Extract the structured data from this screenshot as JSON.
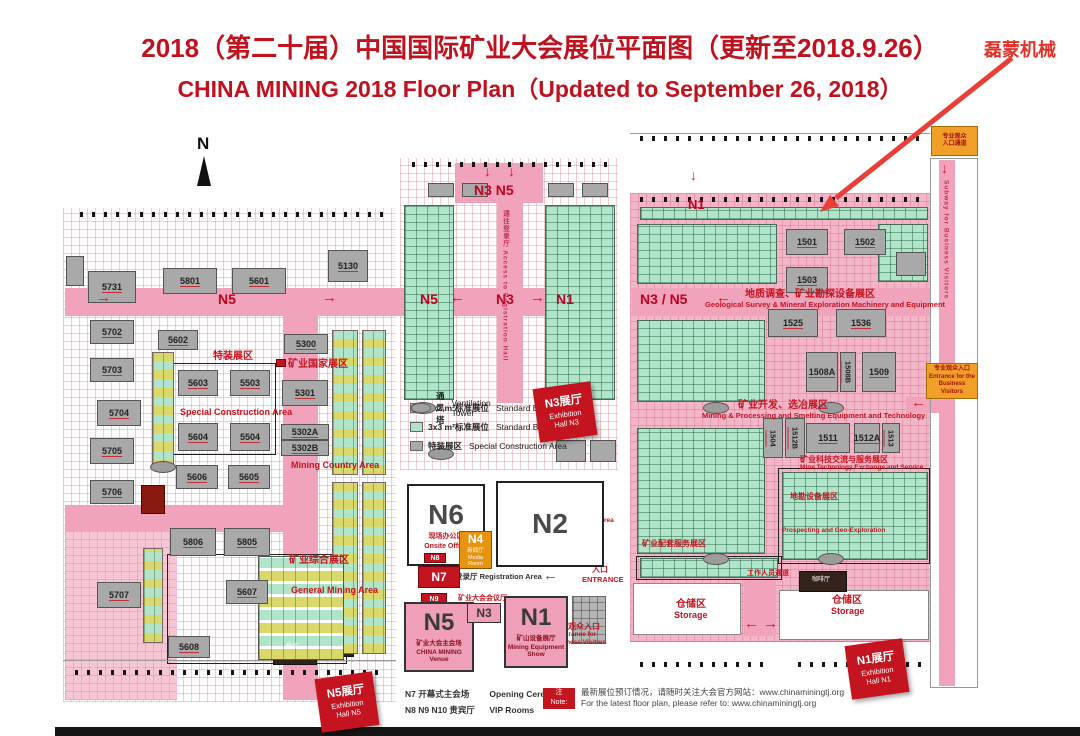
{
  "title": {
    "line1": "2018（第二十届）中国国际矿业大会展位平面图（更新至2018.9.26）",
    "line2": "CHINA MINING 2018 Floor Plan（Updated to September 26, 2018）"
  },
  "annotation": {
    "company": "磊蒙机械"
  },
  "compass": {
    "label": "N"
  },
  "rects": [
    {
      "cls": "hallgrid",
      "x": 63,
      "y": 208,
      "w": 333,
      "h": 494
    },
    {
      "cls": "hallgrid",
      "x": 400,
      "y": 158,
      "w": 218,
      "h": 312
    },
    {
      "cls": "rhall",
      "x": 630,
      "y": 193,
      "w": 301,
      "h": 449
    },
    {
      "cls": "pink",
      "x": 65,
      "y": 288,
      "w": 550,
      "h": 28
    },
    {
      "cls": "pink",
      "x": 632,
      "y": 288,
      "w": 298,
      "h": 28
    },
    {
      "cls": "pink",
      "x": 283,
      "y": 316,
      "w": 35,
      "h": 384
    },
    {
      "cls": "pink",
      "x": 65,
      "y": 505,
      "w": 220,
      "h": 27
    },
    {
      "cls": "pinklight",
      "x": 65,
      "y": 532,
      "w": 112,
      "h": 168
    },
    {
      "cls": "pink",
      "x": 455,
      "y": 163,
      "w": 88,
      "h": 40
    },
    {
      "cls": "pink",
      "x": 497,
      "y": 203,
      "w": 26,
      "h": 200
    },
    {
      "cls": "pink",
      "x": 744,
      "y": 560,
      "w": 32,
      "h": 76
    },
    {
      "cls": "pink",
      "x": 939,
      "y": 160,
      "w": 16,
      "h": 526
    },
    {
      "cls": "pink",
      "x": 906,
      "y": 397,
      "w": 33,
      "h": 16
    },
    {
      "cls": "whitebox",
      "x": 633,
      "y": 583,
      "w": 108,
      "h": 52
    },
    {
      "cls": "whitebox",
      "x": 779,
      "y": 590,
      "w": 150,
      "h": 50
    },
    {
      "cls": "wall",
      "x": 930,
      "y": 158,
      "w": 48,
      "h": 530
    },
    {
      "cls": "wall2",
      "x": 167,
      "y": 554,
      "w": 180,
      "h": 110
    },
    {
      "cls": "wall2",
      "x": 172,
      "y": 363,
      "w": 104,
      "h": 92
    },
    {
      "cls": "wall2",
      "x": 636,
      "y": 556,
      "w": 146,
      "h": 24
    },
    {
      "cls": "wall2",
      "x": 778,
      "y": 468,
      "w": 152,
      "h": 96
    },
    {
      "cls": "tick",
      "x": 80,
      "y": 212,
      "w": 305,
      "h": 5
    },
    {
      "cls": "tick",
      "x": 412,
      "y": 162,
      "w": 195,
      "h": 5
    },
    {
      "cls": "tick",
      "x": 640,
      "y": 197,
      "w": 280,
      "h": 5
    },
    {
      "cls": "tick",
      "x": 640,
      "y": 136,
      "w": 285,
      "h": 5
    },
    {
      "cls": "tick",
      "x": 75,
      "y": 670,
      "w": 310,
      "h": 5
    },
    {
      "cls": "tick",
      "x": 640,
      "y": 662,
      "w": 130,
      "h": 5
    },
    {
      "cls": "tick",
      "x": 798,
      "y": 662,
      "w": 128,
      "h": 5
    },
    {
      "cls": "hline",
      "x": 630,
      "y": 133,
      "w": 300,
      "h": 1
    },
    {
      "cls": "hline",
      "x": 63,
      "y": 660,
      "w": 333,
      "h": 1
    },
    {
      "cls": "hline",
      "x": 630,
      "y": 641,
      "w": 301,
      "h": 1
    },
    {
      "cls": "darkbox",
      "x": 273,
      "y": 632,
      "w": 44,
      "h": 33
    },
    {
      "cls": "darkbox",
      "x": 327,
      "y": 634,
      "w": 27,
      "h": 23
    },
    {
      "cls": "darkbox",
      "x": 799,
      "y": 571,
      "w": 48,
      "h": 21
    },
    {
      "cls": "darkred",
      "x": 141,
      "y": 485,
      "w": 24,
      "h": 29
    },
    {
      "cls": "flag",
      "x": 276,
      "y": 359,
      "w": 10,
      "h": 8
    }
  ],
  "clusters": [
    {
      "cls": "mix-v",
      "x": 152,
      "y": 352,
      "w": 22,
      "h": 118
    },
    {
      "cls": "mix-v",
      "x": 143,
      "y": 548,
      "w": 20,
      "h": 95
    },
    {
      "cls": "mix-v",
      "x": 332,
      "y": 330,
      "w": 26,
      "h": 145
    },
    {
      "cls": "mix-v",
      "x": 332,
      "y": 482,
      "w": 26,
      "h": 172
    },
    {
      "cls": "mix-v",
      "x": 362,
      "y": 330,
      "w": 24,
      "h": 145
    },
    {
      "cls": "mix-v",
      "x": 362,
      "y": 482,
      "w": 24,
      "h": 172
    },
    {
      "cls": "mix-grid",
      "x": 258,
      "y": 556,
      "w": 86,
      "h": 104
    },
    {
      "cls": "green-grid",
      "x": 404,
      "y": 205,
      "w": 50,
      "h": 195
    },
    {
      "cls": "green-grid",
      "x": 545,
      "y": 205,
      "w": 70,
      "h": 195
    },
    {
      "cls": "green-grid",
      "x": 640,
      "y": 207,
      "w": 288,
      "h": 13
    },
    {
      "cls": "green-grid",
      "x": 637,
      "y": 224,
      "w": 140,
      "h": 60
    },
    {
      "cls": "green-grid",
      "x": 878,
      "y": 224,
      "w": 50,
      "h": 58
    },
    {
      "cls": "green-grid",
      "x": 637,
      "y": 320,
      "w": 128,
      "h": 82
    },
    {
      "cls": "green-grid",
      "x": 637,
      "y": 428,
      "w": 128,
      "h": 126
    },
    {
      "cls": "green-grid",
      "x": 640,
      "y": 558,
      "w": 138,
      "h": 20
    },
    {
      "cls": "green-grid",
      "x": 782,
      "y": 472,
      "w": 146,
      "h": 88
    },
    {
      "cls": "gray-grid",
      "x": 546,
      "y": 528,
      "w": 58,
      "h": 36
    },
    {
      "cls": "gray-grid",
      "x": 572,
      "y": 596,
      "w": 34,
      "h": 48
    }
  ],
  "ovals": [
    {
      "x": 150,
      "y": 461
    },
    {
      "x": 428,
      "y": 448
    },
    {
      "x": 703,
      "y": 402
    },
    {
      "x": 818,
      "y": 402
    },
    {
      "x": 703,
      "y": 553
    },
    {
      "x": 818,
      "y": 553
    }
  ],
  "booths": [
    {
      "label": "5731",
      "x": 88,
      "y": 271,
      "w": 48,
      "h": 32
    },
    {
      "label": "5801",
      "x": 163,
      "y": 268,
      "w": 54,
      "h": 26
    },
    {
      "label": "5601",
      "x": 232,
      "y": 268,
      "w": 54,
      "h": 26
    },
    {
      "label": "5130",
      "x": 328,
      "y": 250,
      "w": 40,
      "h": 32
    },
    {
      "label": "5702",
      "x": 90,
      "y": 320,
      "w": 44,
      "h": 24
    },
    {
      "label": "5602",
      "x": 158,
      "y": 330,
      "w": 40,
      "h": 20
    },
    {
      "label": "5703",
      "x": 90,
      "y": 358,
      "w": 44,
      "h": 24
    },
    {
      "label": "5704",
      "x": 97,
      "y": 400,
      "w": 44,
      "h": 26
    },
    {
      "label": "5705",
      "x": 90,
      "y": 438,
      "w": 44,
      "h": 26
    },
    {
      "label": "5706",
      "x": 90,
      "y": 480,
      "w": 44,
      "h": 24
    },
    {
      "label": "5707",
      "x": 97,
      "y": 582,
      "w": 44,
      "h": 26
    },
    {
      "label": "5603",
      "x": 178,
      "y": 370,
      "w": 40,
      "h": 26
    },
    {
      "label": "5503",
      "x": 230,
      "y": 370,
      "w": 40,
      "h": 26
    },
    {
      "label": "5604",
      "x": 178,
      "y": 423,
      "w": 40,
      "h": 28
    },
    {
      "label": "5504",
      "x": 230,
      "y": 423,
      "w": 40,
      "h": 28
    },
    {
      "label": "5606",
      "x": 176,
      "y": 465,
      "w": 42,
      "h": 24
    },
    {
      "label": "5605",
      "x": 228,
      "y": 465,
      "w": 42,
      "h": 24
    },
    {
      "label": "5806",
      "x": 170,
      "y": 528,
      "w": 46,
      "h": 28
    },
    {
      "label": "5805",
      "x": 224,
      "y": 528,
      "w": 46,
      "h": 28
    },
    {
      "label": "5607",
      "x": 226,
      "y": 580,
      "w": 42,
      "h": 24
    },
    {
      "label": "5608",
      "x": 168,
      "y": 636,
      "w": 42,
      "h": 22
    },
    {
      "label": "5300",
      "x": 284,
      "y": 334,
      "w": 44,
      "h": 20
    },
    {
      "label": "5301",
      "x": 282,
      "y": 380,
      "w": 46,
      "h": 26
    },
    {
      "label": "5302A",
      "x": 281,
      "y": 424,
      "w": 48,
      "h": 16
    },
    {
      "label": "5302B",
      "x": 281,
      "y": 440,
      "w": 48,
      "h": 16
    },
    {
      "label": "",
      "x": 428,
      "y": 183,
      "w": 26,
      "h": 14
    },
    {
      "label": "",
      "x": 462,
      "y": 183,
      "w": 26,
      "h": 14
    },
    {
      "label": "",
      "x": 548,
      "y": 183,
      "w": 26,
      "h": 14
    },
    {
      "label": "",
      "x": 582,
      "y": 183,
      "w": 26,
      "h": 14
    },
    {
      "label": "",
      "x": 556,
      "y": 440,
      "w": 30,
      "h": 22
    },
    {
      "label": "",
      "x": 590,
      "y": 440,
      "w": 26,
      "h": 22
    },
    {
      "label": "1501",
      "x": 786,
      "y": 229,
      "w": 42,
      "h": 26
    },
    {
      "label": "1502",
      "x": 844,
      "y": 229,
      "w": 42,
      "h": 26
    },
    {
      "label": "1503",
      "x": 786,
      "y": 267,
      "w": 42,
      "h": 26
    },
    {
      "label": "1525",
      "x": 768,
      "y": 309,
      "w": 50,
      "h": 28
    },
    {
      "label": "1536",
      "x": 836,
      "y": 309,
      "w": 50,
      "h": 28
    },
    {
      "label": "1508A",
      "x": 806,
      "y": 352,
      "w": 32,
      "h": 40
    },
    {
      "label": "1508B",
      "cls": "vert",
      "x": 840,
      "y": 352,
      "w": 16,
      "h": 40
    },
    {
      "label": "1509",
      "x": 862,
      "y": 352,
      "w": 34,
      "h": 40
    },
    {
      "label": "1504",
      "cls": "vert",
      "x": 763,
      "y": 418,
      "w": 20,
      "h": 40
    },
    {
      "label": "1512B",
      "cls": "vert",
      "x": 785,
      "y": 418,
      "w": 20,
      "h": 40
    },
    {
      "label": "1511",
      "x": 806,
      "y": 423,
      "w": 44,
      "h": 30
    },
    {
      "label": "1512A",
      "x": 854,
      "y": 423,
      "w": 26,
      "h": 30
    },
    {
      "label": "1513",
      "cls": "vert",
      "x": 882,
      "y": 423,
      "w": 18,
      "h": 30
    },
    {
      "label": "",
      "x": 66,
      "y": 256,
      "w": 18,
      "h": 30
    },
    {
      "label": "",
      "x": 896,
      "y": 252,
      "w": 30,
      "h": 24
    }
  ],
  "labels": [
    {
      "cls": "corr-arrow",
      "text": "→",
      "x": 96,
      "y": 290
    },
    {
      "cls": "corr",
      "text": "N5",
      "x": 218,
      "y": 292
    },
    {
      "cls": "corr-arrow",
      "text": "→",
      "x": 322,
      "y": 290
    },
    {
      "cls": "corr",
      "text": "N5",
      "x": 420,
      "y": 292
    },
    {
      "cls": "corr-arrow",
      "text": "←",
      "x": 450,
      "y": 290
    },
    {
      "cls": "corr",
      "text": "N3",
      "x": 496,
      "y": 292
    },
    {
      "cls": "corr-arrow",
      "text": "→",
      "x": 530,
      "y": 290
    },
    {
      "cls": "corr",
      "text": "N1",
      "x": 556,
      "y": 292
    },
    {
      "cls": "corr",
      "text": "N3 / N5",
      "x": 640,
      "y": 292
    },
    {
      "cls": "corr-arrow",
      "text": "←",
      "x": 716,
      "y": 290
    },
    {
      "cls": "corr",
      "text": "N3 N5",
      "x": 474,
      "y": 183
    },
    {
      "cls": "corr-arrow-d",
      "text": "↓",
      "x": 484,
      "y": 164
    },
    {
      "cls": "corr-arrow-d",
      "text": "↓",
      "x": 508,
      "y": 164
    },
    {
      "cls": "corr-sm",
      "text": "N1",
      "x": 688,
      "y": 198
    },
    {
      "cls": "corr-arrow-d",
      "text": "↓",
      "x": 690,
      "y": 168
    },
    {
      "cls": "corr-arrow-d",
      "text": "↓",
      "x": 941,
      "y": 161
    },
    {
      "cls": "corr-arrow",
      "text": "← →",
      "x": 744,
      "y": 616
    },
    {
      "cls": "corr-arrow",
      "text": "←",
      "x": 911,
      "y": 395
    },
    {
      "cls": "corr-arrow",
      "text": "←",
      "x": 543,
      "y": 568
    },
    {
      "cls": "zh",
      "text": "特装展区",
      "x": 213,
      "y": 352
    },
    {
      "cls": "en",
      "text": "Special Construction Area",
      "x": 180,
      "y": 408
    },
    {
      "cls": "zh",
      "text": "矿业国家展区",
      "x": 288,
      "y": 360
    },
    {
      "cls": "en",
      "text": "Mining Country Area",
      "x": 291,
      "y": 461
    },
    {
      "cls": "zh",
      "text": "矿业综合展区",
      "x": 289,
      "y": 556
    },
    {
      "cls": "en",
      "text": "General Mining Area",
      "x": 291,
      "y": 586
    },
    {
      "cls": "zh",
      "text": "地质调查、矿业勘探设备展区",
      "x": 745,
      "y": 290
    },
    {
      "cls": "en-xs",
      "text": "Geological Survey & Mineral Exploration Machinery and Equipment",
      "x": 705,
      "y": 301
    },
    {
      "cls": "zh",
      "text": "矿业开发、选冶展区",
      "x": 738,
      "y": 401
    },
    {
      "cls": "en-xs",
      "text": "Mining & Processing and Smelting Equipment and Technology",
      "x": 702,
      "y": 412
    },
    {
      "cls": "zh-sm",
      "text": "矿业科技交流与服务展区",
      "x": 800,
      "y": 456
    },
    {
      "cls": "en-xxs",
      "text": "Mine Technology Exchange and Service",
      "x": 800,
      "y": 465
    },
    {
      "cls": "zh-sm",
      "text": "地勘设备展区",
      "x": 790,
      "y": 493
    },
    {
      "cls": "en-xxs",
      "text": "Prospecting and Geo-Exploration",
      "x": 782,
      "y": 528
    },
    {
      "cls": "zh-sm",
      "text": "矿业配套服务展区",
      "x": 642,
      "y": 540
    },
    {
      "cls": "zh-xxs",
      "text": "工作人员通道",
      "x": 747,
      "y": 570
    },
    {
      "cls": "zh",
      "text": "仓储区",
      "x": 676,
      "y": 600
    },
    {
      "cls": "en",
      "text": "Storage",
      "x": 674,
      "y": 611
    },
    {
      "cls": "zh",
      "text": "仓储区",
      "x": 832,
      "y": 596
    },
    {
      "cls": "en",
      "text": "Storage",
      "x": 831,
      "y": 607
    },
    {
      "cls": "zh-sm",
      "text": "室外矿山",
      "x": 560,
      "y": 491
    },
    {
      "cls": "zh-sm",
      "text": "设备展区",
      "x": 560,
      "y": 500
    },
    {
      "cls": "en-xxs",
      "text": "Outdoor Mining",
      "x": 552,
      "y": 510
    },
    {
      "cls": "en-xxs",
      "text": "Equipment Show Area",
      "x": 545,
      "y": 518
    },
    {
      "cls": "zh-sm",
      "text": "专业观众入口",
      "x": 552,
      "y": 623
    },
    {
      "cls": "en-xxs",
      "text": "Entrance for",
      "x": 558,
      "y": 632
    },
    {
      "cls": "en-xxs",
      "text": "Business Visitors",
      "x": 552,
      "y": 640
    },
    {
      "cls": "zh-sm",
      "text": "入口",
      "x": 592,
      "y": 566
    },
    {
      "cls": "en-xs",
      "text": "ENTRANCE",
      "x": 582,
      "y": 576
    },
    {
      "cls": "dk",
      "text": "登录厅 Registration Area",
      "x": 455,
      "y": 573
    },
    {
      "cls": "zh-xxs",
      "text": "矿业大会会议厅",
      "x": 458,
      "y": 595
    },
    {
      "cls": "vert-red",
      "text": "通往登录厅 Access to Registration Hall",
      "x": 501,
      "y": 210,
      "h": 180
    },
    {
      "cls": "vert-red",
      "text": "Subway for Business Visitors",
      "x": 942,
      "y": 180,
      "h": 170
    },
    {
      "cls": "cafe",
      "text": "咖啡厅",
      "x": 812,
      "y": 577
    },
    {
      "cls": "cafe",
      "text": "餐厅",
      "x": 286,
      "y": 644
    }
  ],
  "buildings": [
    {
      "id": "N6",
      "sub1": "现场办公区",
      "sub2": "Onsite Office",
      "cls": "b-white",
      "x": 407,
      "y": 484,
      "w": 78,
      "h": 82
    },
    {
      "id": "N2",
      "cls": "b-white",
      "x": 496,
      "y": 481,
      "w": 108,
      "h": 86
    },
    {
      "id": "N4",
      "sub1": "新闻厅",
      "sub2": "Media Room",
      "cls": "b-orange",
      "x": 459,
      "y": 531,
      "w": 33,
      "h": 38
    },
    {
      "id": "N7",
      "cls": "b-red",
      "x": 418,
      "y": 566,
      "w": 42,
      "h": 22
    },
    {
      "id": "N8",
      "cls": "b-red-xs",
      "x": 424,
      "y": 553,
      "w": 22,
      "h": 10
    },
    {
      "id": "N9",
      "cls": "b-red-xs",
      "x": 421,
      "y": 593,
      "w": 26,
      "h": 12
    },
    {
      "id": "N5",
      "sub1": "矿业大会主会场",
      "sub2": "CHINA MINING Venue",
      "cls": "b-pink",
      "x": 404,
      "y": 602,
      "w": 70,
      "h": 70
    },
    {
      "id": "N3",
      "cls": "b-pink-sm",
      "x": 467,
      "y": 603,
      "w": 34,
      "h": 20
    },
    {
      "id": "N1",
      "sub1": "矿山设备展厅",
      "sub2": "Mining Equipment Show",
      "cls": "b-pink",
      "x": 504,
      "y": 596,
      "w": 64,
      "h": 72
    }
  ],
  "entrances": [
    {
      "l1": "专业观众",
      "l2": "入口通道",
      "x": 931,
      "y": 126,
      "w": 47,
      "h": 30
    },
    {
      "l1": "专业观众入口",
      "l2": "Entrance for the",
      "l3": "Business Visitors",
      "x": 926,
      "y": 363,
      "w": 52,
      "h": 36
    }
  ],
  "badges": [
    {
      "l1": "N3展厅",
      "l2": "Exhibition",
      "l3": "Hall N3",
      "x": 536,
      "y": 385,
      "rot": -8
    },
    {
      "l1": "N5展厅",
      "l2": "Exhibition",
      "l3": "Hall N5",
      "x": 318,
      "y": 675,
      "rot": -8
    },
    {
      "l1": "N1展厅",
      "l2": "Exhibition",
      "l3": "Hall N1",
      "x": 848,
      "y": 642,
      "rot": -8
    }
  ],
  "legend": {
    "items": [
      {
        "cls": "yellow",
        "zh": "3x2 m²标准展位",
        "en": "Standard Booth"
      },
      {
        "cls": "green",
        "zh": "3x3 m²标准展位",
        "en": "Standard Booth"
      },
      {
        "cls": "gray",
        "zh": "特装展区",
        "en": "Special Construction Area"
      },
      {
        "cls": "oval",
        "zh": "通风塔",
        "en": "Ventilation Tower"
      }
    ]
  },
  "footer": {
    "row1_zh": "N7 开幕式主会场",
    "row1_en": "Opening Ceremony",
    "row2_zh": "N8 N9 N10 贵宾厅",
    "row2_en": "VIP Rooms",
    "note_badge_l1": "注",
    "note_badge_l2": "Note:",
    "note_zh": "最新展位预订情况，请随时关注大会官方网站：www.chinaminingtj.org",
    "note_en": "For the latest floor plan, please refer to: www.chinaminingtj.org"
  }
}
